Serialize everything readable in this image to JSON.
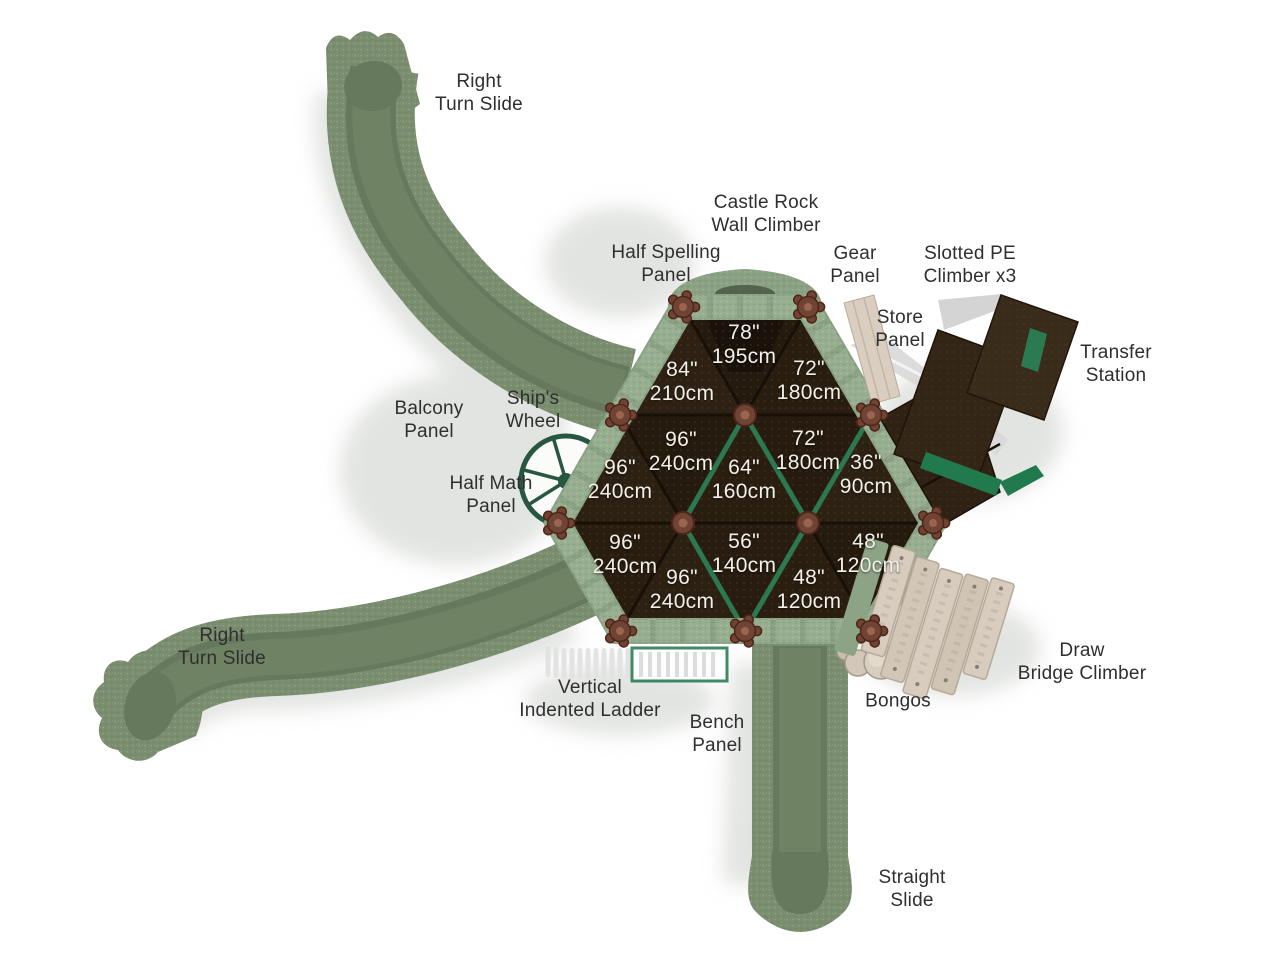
{
  "labels": {
    "right_turn_slide_top": "Right\nTurn Slide",
    "castle_rock_wall_climber": "Castle Rock\nWall Climber",
    "half_spelling_panel": "Half Spelling\nPanel",
    "gear_panel": "Gear\nPanel",
    "slotted_pe_climber": "Slotted PE\nClimber x3",
    "store_panel": "Store\nPanel",
    "transfer_station": "Transfer\nStation",
    "balcony_panel": "Balcony\nPanel",
    "ships_wheel": "Ship's\nWheel",
    "half_math_panel": "Half Math\nPanel",
    "right_turn_slide_bottom": "Right\nTurn Slide",
    "vertical_indented_ladder": "Vertical\nIndented Ladder",
    "bench_panel": "Bench\nPanel",
    "bongos": "Bongos",
    "draw_bridge_climber": "Draw\nBridge Climber",
    "straight_slide": "Straight\nSlide"
  },
  "decks": [
    {
      "inches": "78\"",
      "cm": "195cm"
    },
    {
      "inches": "84\"",
      "cm": "210cm"
    },
    {
      "inches": "72\"",
      "cm": "180cm"
    },
    {
      "inches": "96\"",
      "cm": "240cm"
    },
    {
      "inches": "72\"",
      "cm": "180cm"
    },
    {
      "inches": "96\"",
      "cm": "240cm"
    },
    {
      "inches": "64\"",
      "cm": "160cm"
    },
    {
      "inches": "36\"",
      "cm": "90cm"
    },
    {
      "inches": "96\"",
      "cm": "240cm"
    },
    {
      "inches": "56\"",
      "cm": "140cm"
    },
    {
      "inches": "48\"",
      "cm": "120cm"
    },
    {
      "inches": "96\"",
      "cm": "240cm"
    },
    {
      "inches": "48\"",
      "cm": "120cm"
    }
  ],
  "palette": {
    "slide_green": "#7a8e6f",
    "slide_channel_green": "#66795c",
    "border_green": "#8aa183",
    "deck_brown": "#2b1f12",
    "post_rust": "#6f4434",
    "plank_tan": "#d7ccbe",
    "rail_green": "#2c7d55",
    "label_text": "#2f2f2f",
    "measurement_text": "#f3f0ea"
  }
}
